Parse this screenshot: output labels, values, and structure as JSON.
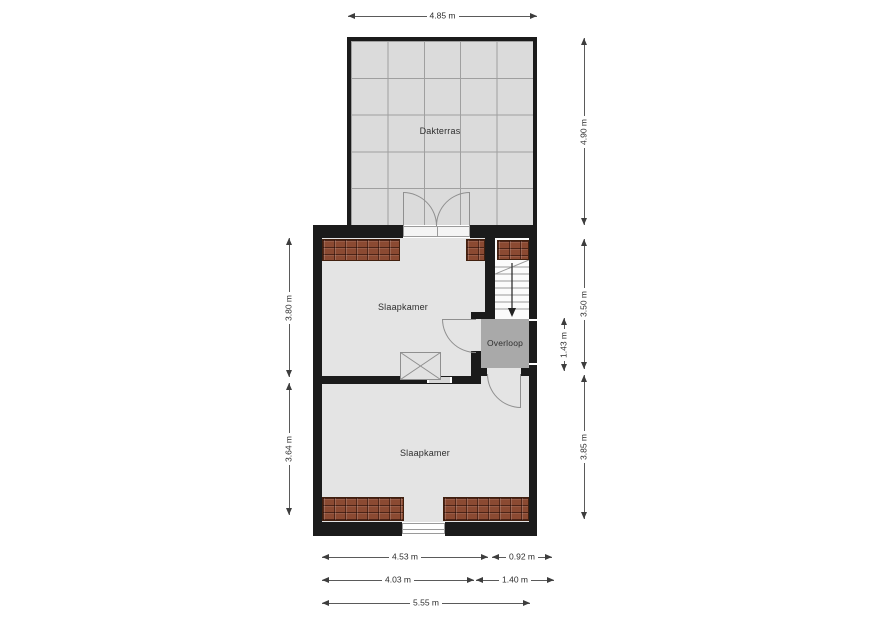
{
  "plan": {
    "rooms": {
      "dakterras": "Dakterras",
      "slaapkamer1": "Slaapkamer",
      "slaapkamer2": "Slaapkamer",
      "overloop": "Overloop"
    },
    "dimensions": {
      "terrace_width": "4.85 m",
      "terrace_depth": "4.90 m",
      "upper_room_left": "3.80 m",
      "lower_room_left": "3.64 m",
      "stair_zone_right": "3.50 m",
      "overloop_depth": "1.43 m",
      "lower_room_right": "3.85 m",
      "bottom_row1_left": "4.53 m",
      "bottom_row1_right": "0.92 m",
      "bottom_row2_left": "4.03 m",
      "bottom_row2_right": "1.40 m",
      "bottom_total": "5.55 m"
    },
    "colors": {
      "wall": "#1b1b1b",
      "room_fill": "#e4e4e4",
      "terrace_fill": "#dbdbdb",
      "overloop_fill": "#a9a9a9",
      "roof_brick": "#8b4a32",
      "dim_line": "#5a5a5a",
      "stairs_fill": "#fbfbfb"
    }
  }
}
